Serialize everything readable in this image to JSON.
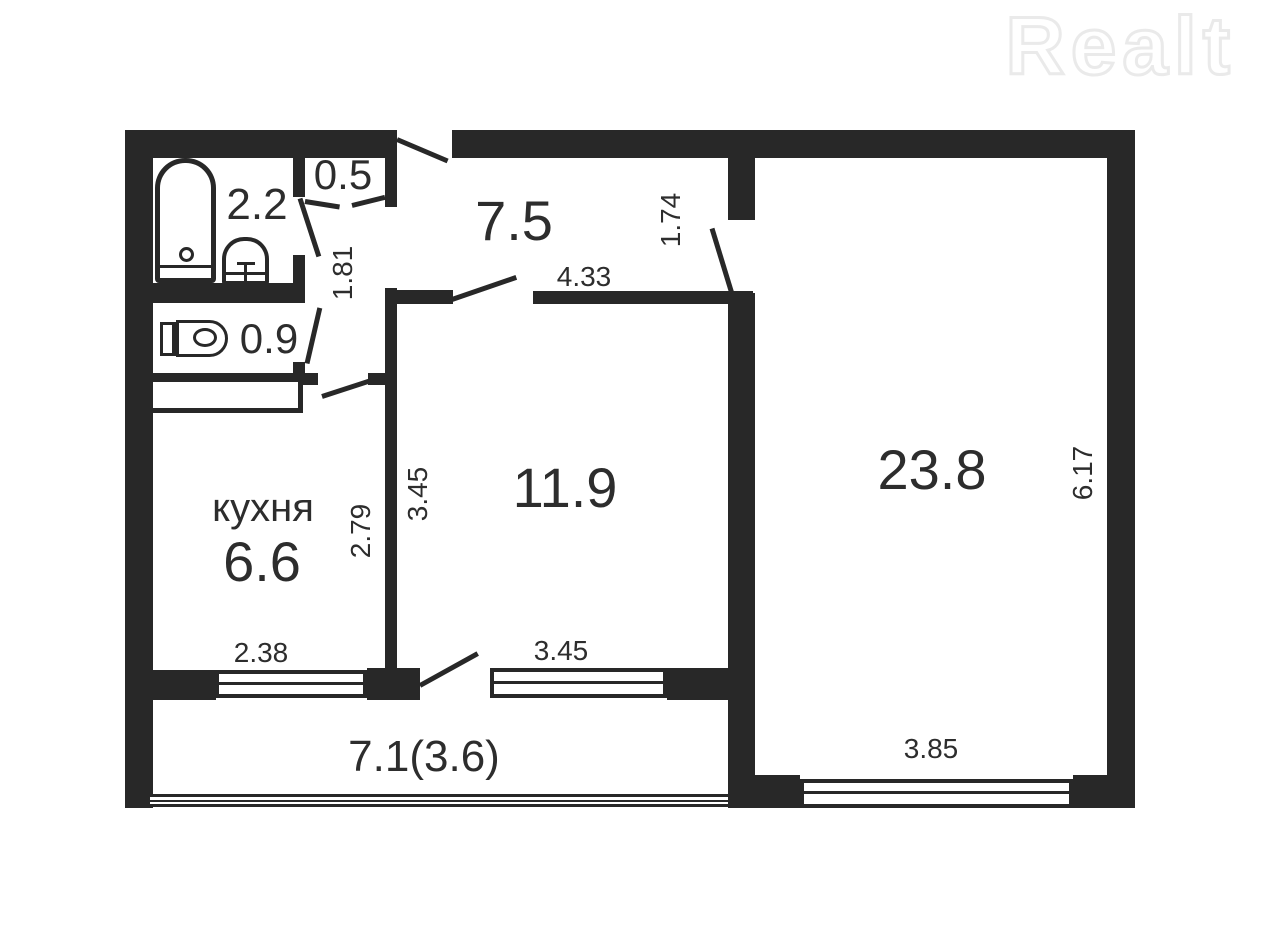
{
  "watermark": "Realt",
  "plan": {
    "rooms": {
      "bath": "2.2",
      "closet": "0.5",
      "hall": "7.5",
      "wc": "0.9",
      "kitchen_name": "кухня",
      "kitchen": "6.6",
      "room_mid": "11.9",
      "room_large": "23.8",
      "balcony": "7.1(3.6)"
    },
    "dims": {
      "corridor_length": "1.81",
      "hall_width": "4.33",
      "passage": "1.74",
      "room_mid_height": "3.45",
      "kitchen_height": "2.79",
      "kitchen_window": "2.38",
      "room_mid_window": "3.45",
      "room_large_height": "6.17",
      "room_large_window": "3.85"
    }
  }
}
